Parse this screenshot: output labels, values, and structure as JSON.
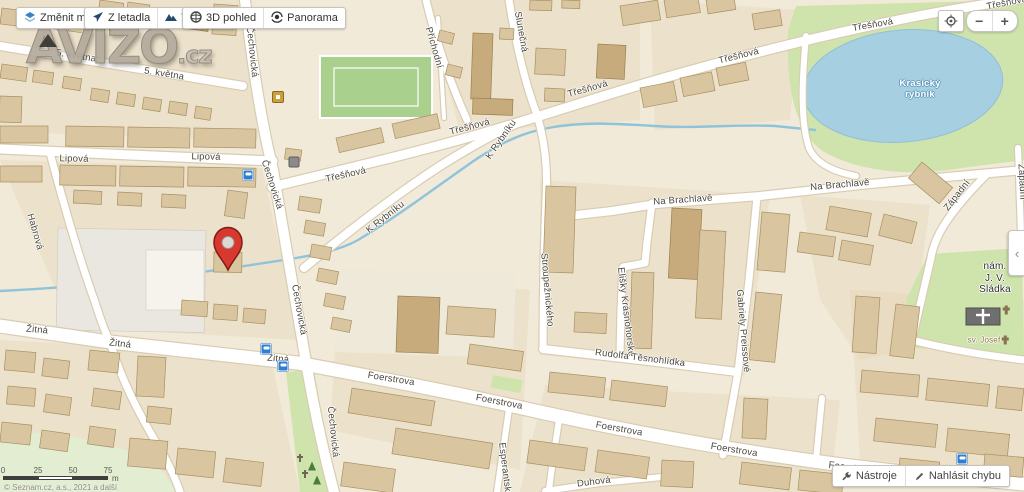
{
  "logo": {
    "name": "AVIZO",
    "tld": ".cz"
  },
  "toolbar": {
    "buttons": [
      {
        "label": "Změnit mapu",
        "icon": "map-switch-icon"
      },
      {
        "label": "Z letadla",
        "icon": "aerial-plane-icon"
      },
      {
        "label": "Turistická",
        "icon": "tourist-mountains-icon"
      },
      {
        "label": "3D pohled",
        "icon": "globe-3d-icon"
      },
      {
        "label": "Panorama",
        "icon": "panorama-eye-icon"
      }
    ]
  },
  "map_controls": {
    "locate_icon": "locate-target-icon",
    "zoom_out": "−",
    "zoom_in": "+",
    "panel_toggle": "‹"
  },
  "footer": {
    "tools": {
      "label": "Nástroje",
      "icon": "tools-wrench-icon"
    },
    "report": {
      "label": "Nahlásit chybu",
      "icon": "report-pencil-icon"
    },
    "copyright": "© Seznam.cz, a.s., 2021 a další"
  },
  "scale_bar": {
    "ticks": [
      "0",
      "25",
      "50",
      "75"
    ],
    "unit": "m"
  },
  "colors": {
    "land": "#f1ead9",
    "building": "#d9c6a0",
    "road": "#ffffff",
    "green": "#cfe4ad",
    "water": "#a6cfe2",
    "marker_red": "#d8382e",
    "accent_blue": "#2f7fd1"
  },
  "map": {
    "marker": {
      "x": 228,
      "y": 270
    },
    "street_labels": [
      {
        "t": "5. května",
        "x": 76,
        "y": 57,
        "r": 9
      },
      {
        "t": "5. května",
        "x": 164,
        "y": 75,
        "r": 9
      },
      {
        "t": "Lipová",
        "x": 74,
        "y": 160,
        "r": 1
      },
      {
        "t": "Lipová",
        "x": 206,
        "y": 158,
        "r": 1
      },
      {
        "t": "Habrová",
        "x": 34,
        "y": 232,
        "r": 74
      },
      {
        "t": "Čechovická",
        "x": 251,
        "y": 52,
        "r": 84
      },
      {
        "t": "Čechovická",
        "x": 271,
        "y": 185,
        "r": 72
      },
      {
        "t": "Čechovická",
        "x": 298,
        "y": 310,
        "r": 80
      },
      {
        "t": "Čechovická",
        "x": 332,
        "y": 432,
        "r": 84
      },
      {
        "t": "Třešňová",
        "x": 346,
        "y": 176,
        "r": -13
      },
      {
        "t": "Třešňová",
        "x": 470,
        "y": 128,
        "r": -15
      },
      {
        "t": "Třešňová",
        "x": 588,
        "y": 90,
        "r": -16
      },
      {
        "t": "Třešňová",
        "x": 739,
        "y": 57,
        "r": -14
      },
      {
        "t": "Třešňová",
        "x": 873,
        "y": 26,
        "r": -10
      },
      {
        "t": "Třešňová",
        "x": 1007,
        "y": 4,
        "r": -11
      },
      {
        "t": "Příchodní",
        "x": 433,
        "y": 48,
        "r": 74
      },
      {
        "t": "Slunečná",
        "x": 520,
        "y": 32,
        "r": 80
      },
      {
        "t": "K Rybníku",
        "x": 386,
        "y": 218,
        "r": -38
      },
      {
        "t": "K Rybníku",
        "x": 502,
        "y": 140,
        "r": -55
      },
      {
        "t": "Stroupežnického",
        "x": 546,
        "y": 290,
        "r": 85
      },
      {
        "t": "Na Brachlavě",
        "x": 683,
        "y": 201,
        "r": -4
      },
      {
        "t": "Na Brachlavě",
        "x": 840,
        "y": 186,
        "r": -5
      },
      {
        "t": "Elišky Krásnohorské",
        "x": 625,
        "y": 312,
        "r": 83
      },
      {
        "t": "Rudolfa Těsnohlídka",
        "x": 640,
        "y": 359,
        "r": 7
      },
      {
        "t": "Gabriely Preissové",
        "x": 742,
        "y": 331,
        "r": 85
      },
      {
        "t": "Západní",
        "x": 958,
        "y": 196,
        "r": -52
      },
      {
        "t": "Západní",
        "x": 1021,
        "y": 182,
        "r": 87
      },
      {
        "t": "Žitná",
        "x": 37,
        "y": 331,
        "r": 5
      },
      {
        "t": "Žitná",
        "x": 120,
        "y": 345,
        "r": 6
      },
      {
        "t": "Žitná",
        "x": 278,
        "y": 360,
        "r": 5
      },
      {
        "t": "Foerstrova",
        "x": 391,
        "y": 380,
        "r": 9
      },
      {
        "t": "Foerstrova",
        "x": 499,
        "y": 403,
        "r": 11
      },
      {
        "t": "Foerstrova",
        "x": 619,
        "y": 430,
        "r": 10
      },
      {
        "t": "Foerstrova",
        "x": 734,
        "y": 451,
        "r": 9
      },
      {
        "t": "Foerstrova",
        "x": 852,
        "y": 469,
        "r": 7
      },
      {
        "t": "Duhová",
        "x": 594,
        "y": 483,
        "r": -7
      },
      {
        "t": "Esperantská",
        "x": 504,
        "y": 470,
        "r": 83
      },
      {
        "t": "nám.\nJ. V. Sládka",
        "x": 995,
        "y": 278,
        "r": 0,
        "c": "place"
      },
      {
        "t": "sv. Josef",
        "x": 984,
        "y": 340,
        "r": 0,
        "c": "poi-l"
      },
      {
        "t": "Krasický\nrybník",
        "x": 920,
        "y": 90,
        "r": 0,
        "c": "water-l"
      }
    ],
    "poi_icons": [
      {
        "icon": "bus-stop-icon",
        "x": 248,
        "y": 175
      },
      {
        "icon": "bus-stop-icon",
        "x": 266,
        "y": 349
      },
      {
        "icon": "bus-stop-icon",
        "x": 283,
        "y": 366
      },
      {
        "icon": "bus-stop-icon",
        "x": 962,
        "y": 459
      },
      {
        "icon": "school-icon",
        "x": 278,
        "y": 97
      },
      {
        "icon": "public-building-icon",
        "x": 294,
        "y": 162
      },
      {
        "icon": "tree-icon",
        "x": 312,
        "y": 466
      },
      {
        "icon": "tree-icon",
        "x": 317,
        "y": 480
      },
      {
        "icon": "grave-cross-icon",
        "x": 305,
        "y": 474
      },
      {
        "icon": "grave-cross-icon",
        "x": 300,
        "y": 458
      },
      {
        "icon": "church-cross-icon",
        "x": 1006,
        "y": 310
      },
      {
        "icon": "church-cross-icon",
        "x": 1005,
        "y": 340
      }
    ]
  }
}
